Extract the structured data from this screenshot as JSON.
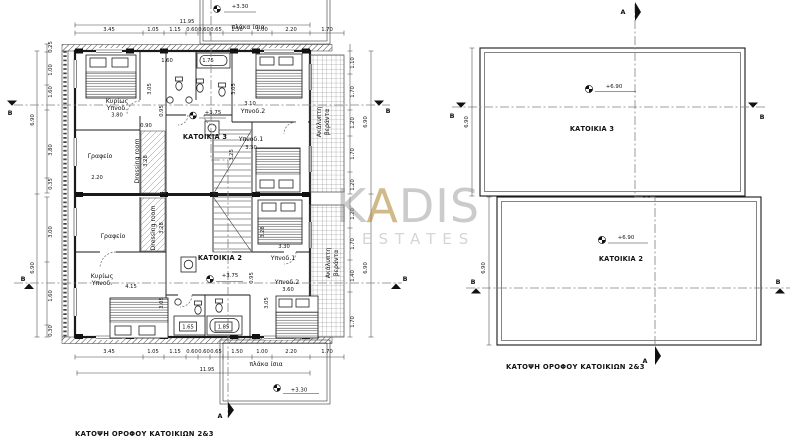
{
  "floor_plan": {
    "caption": "ΚΑΤΟΨΗ ΟΡΟΦΟΥ ΚΑΤΟΙΚΙΩΝ 2&3",
    "slab_label": "πλάκα ίσια",
    "overall_width": "11.95",
    "height_total": "6.90",
    "levels": {
      "slab": "+3.30"
    },
    "top_dims": [
      "3.45",
      "1.05",
      "1.15",
      "0.60",
      "0.60",
      "0.65",
      "1.50",
      "1.00",
      "2.20",
      "1.70"
    ],
    "bottom_dims": [
      "3.45",
      "1.05",
      "1.15",
      "0.60",
      "0.60",
      "0.65",
      "1.50",
      "1.00",
      "2.20",
      "1.70"
    ],
    "left_dims_top": [
      "0.25",
      "1.00",
      "1.60",
      "3.80",
      "0.35"
    ],
    "left_dims_bottom": [
      "3.00",
      "1.60",
      "0.30"
    ],
    "right_dims_top": [
      "1.10",
      "1.70",
      "1.20",
      "1.70",
      "1.20"
    ],
    "right_dims_bottom": [
      "1.20",
      "1.70",
      "1.40",
      "1.70"
    ],
    "veranda_line1": "Ακάλυπτη",
    "veranda_line2": "βεράντα",
    "section_a": "A",
    "section_b": "B",
    "unit3": {
      "name": "ΚΑΤΟΙΚΙΑ 3",
      "level": "+3.75",
      "master_line1": "Κυρίως",
      "master_line2": "Υπνοδ.",
      "master_dim": "3.80",
      "office": "Γραφείο",
      "office_dim": "2.20",
      "dressing": "Dressing room",
      "dressing_dim": "3.28",
      "bed1": "Υπνοδ.1",
      "bed1_dim": "3.30",
      "bed2": "Υπνοδ.2",
      "bed2_dim": "3.10",
      "dim_160": "1.60",
      "dim_175": "1.75",
      "dim_090": "0.90",
      "dim_095": "0.95",
      "dim_305_left": "3.05",
      "dim_305_right": "3.05",
      "dim_325": "3.25"
    },
    "unit2": {
      "name": "ΚΑΤΟΙΚΙΑ 2",
      "level": "+3.75",
      "master_line1": "Κυρίως",
      "master_line2": "Υπνοδ.",
      "master_dim": "4.15",
      "office": "Γραφείο",
      "dressing": "Dressing room",
      "dressing_dim": "3.28",
      "bed1": "Υπνοδ.1",
      "bed1_dim": "3.30",
      "bed2": "Υπνοδ.2",
      "bed2_dim": "3.60",
      "dim_328": "3.28",
      "dim_305_left": "3.05",
      "dim_305_right": "3.05",
      "dim_095": "0.95",
      "shower_dim": "1.65",
      "tub_dim": "1.85"
    }
  },
  "roof_plan": {
    "caption": "ΚΑΤΟΨΗ ΟΡΟΦΟΥ ΚΑΤΟΙΚΙΩΝ 2&3",
    "unit3_label": "ΚΑΤΟΙΚΙΑ 3",
    "unit2_label": "ΚΑΤΟΙΚΙΑ 2",
    "unit3_level": "+6.90",
    "unit2_level": "+6.90",
    "height_dim": "6.90",
    "section_a": "A",
    "section_b": "B"
  },
  "watermark": {
    "part1": "K",
    "part2": "A",
    "part3": "DIS",
    "subtitle": "ESTATES"
  }
}
